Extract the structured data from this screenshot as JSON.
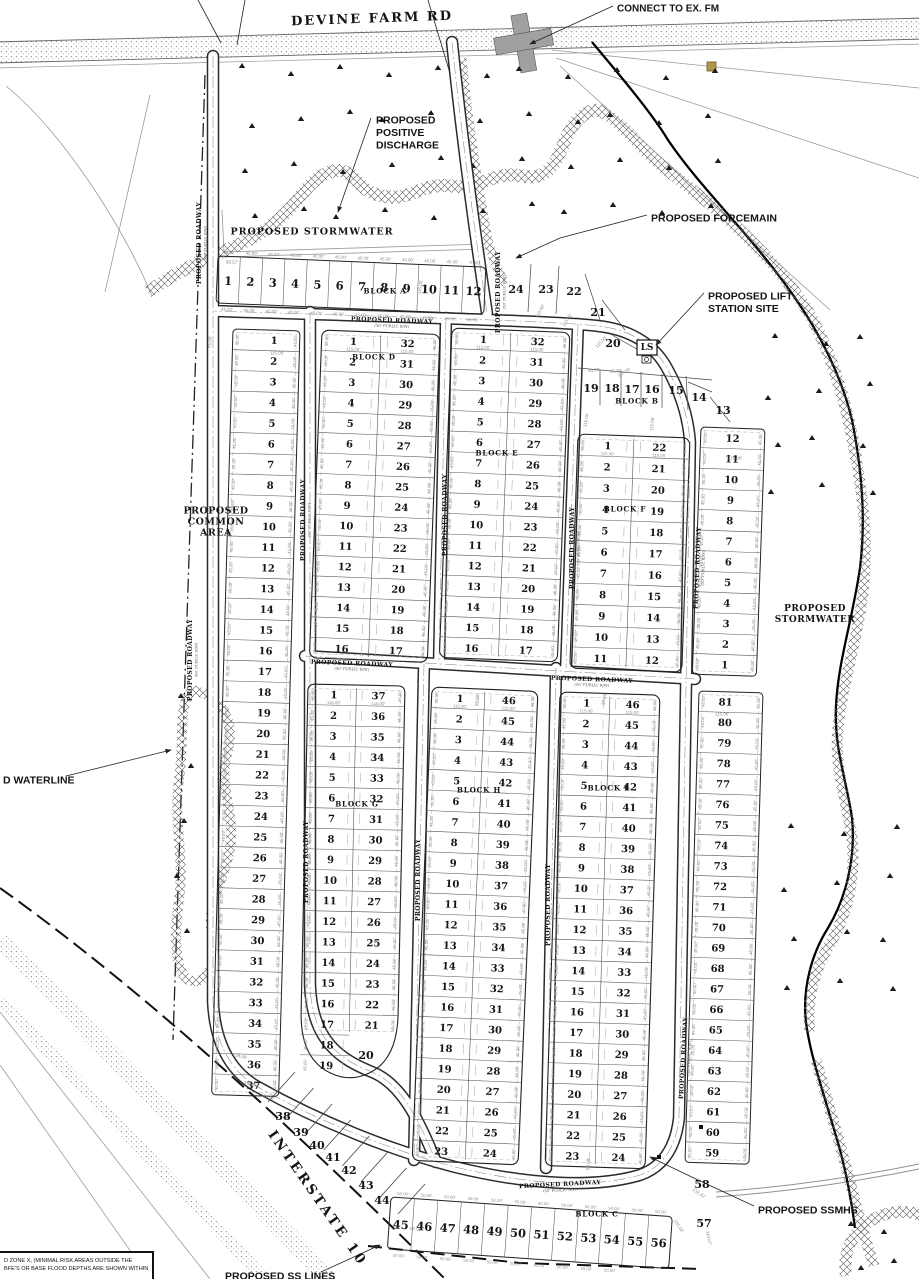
{
  "defaults": {
    "roadway_label": "PROPOSED ROADWAY",
    "lot_side_dim": "45.00'",
    "lot_depth_dim": "115.00'"
  },
  "note_box": {
    "line1": "D ZONE X, (MINIMAL RISK AREAS OUTSIDE THE",
    "line2": "BFE'S OR BASE FLOOD DEPTHS ARE SHOWN WITHIN"
  },
  "ls_box": {
    "label": "LS"
  },
  "annotations": [
    {
      "name": "connect-to-ex-fm",
      "lines": [
        "CONNECT TO EX. FM"
      ],
      "x": 617,
      "y": 8,
      "anchor": "start",
      "fs": 10,
      "leader": [
        [
          613,
          6
        ],
        [
          530,
          44
        ]
      ],
      "arrow": true
    },
    {
      "name": "proposed-positive-discharge",
      "lines": [
        "PROPOSED",
        "POSITIVE",
        "DISCHARGE"
      ],
      "x": 376,
      "y": 120,
      "anchor": "start",
      "fs": 10.5,
      "leader": [
        [
          371,
          118
        ],
        [
          338,
          212
        ]
      ],
      "arrow": true
    },
    {
      "name": "proposed-stormwater-top",
      "lines": [
        "PROPOSED STORMWATER"
      ],
      "x": 312,
      "y": 231,
      "anchor": "middle",
      "fs": 9.5,
      "serif": true,
      "ls": 1
    },
    {
      "name": "proposed-forcemain",
      "lines": [
        "PROPOSED FORCEMAIN"
      ],
      "x": 651,
      "y": 218,
      "anchor": "start",
      "fs": 10.5,
      "leader": [
        [
          647,
          215
        ],
        [
          560,
          238
        ],
        [
          516,
          258
        ]
      ],
      "arrow": true
    },
    {
      "name": "proposed-lift-station-site",
      "lines": [
        "PROPOSED LIFT",
        "STATION SITE"
      ],
      "x": 708,
      "y": 296,
      "anchor": "start",
      "fs": 10.5,
      "leader": [
        [
          704,
          293
        ],
        [
          656,
          345
        ]
      ],
      "arrow": true
    },
    {
      "name": "proposed-stormwater-right",
      "lines": [
        "PROPOSED",
        "STORMWATER"
      ],
      "x": 815,
      "y": 608,
      "anchor": "middle",
      "fs": 9,
      "serif": true,
      "ls": 0.5
    },
    {
      "name": "proposed-common-area",
      "lines": [
        "PROPOSED",
        "COMMON",
        "AREA"
      ],
      "x": 216,
      "y": 510,
      "anchor": "middle",
      "fs": 9.5,
      "serif": true,
      "ls": 0.5
    },
    {
      "name": "proposed-waterline",
      "lines": [
        "D WATERLINE"
      ],
      "x": 3,
      "y": 780,
      "anchor": "start",
      "fs": 10.5,
      "leader": [
        [
          66,
          776
        ],
        [
          171,
          750
        ]
      ],
      "arrow": true
    },
    {
      "name": "proposed-ssmhs",
      "lines": [
        "PROPOSED SSMHS"
      ],
      "x": 758,
      "y": 1210,
      "anchor": "start",
      "fs": 10.5,
      "leader": [
        [
          754,
          1206
        ],
        [
          698,
          1180
        ],
        [
          650,
          1157
        ]
      ],
      "arrow": true
    },
    {
      "name": "proposed-ss-lines",
      "lines": [
        "PROPOSED SS LINES"
      ],
      "x": 225,
      "y": 1276,
      "anchor": "start",
      "fs": 10.5,
      "leader": [
        [
          321,
          1272
        ],
        [
          380,
          1245
        ]
      ],
      "arrow": true
    },
    {
      "name": "devine-farm-rd",
      "lines": [
        "DEVINE FARM RD"
      ],
      "x": 372,
      "y": 18,
      "anchor": "middle",
      "fs": 13,
      "serif": true,
      "rot": -2,
      "ls": 2
    },
    {
      "name": "interstate-10",
      "lines": [
        "INTERSTATE 10"
      ],
      "x": 318,
      "y": 1198,
      "anchor": "middle",
      "fs": 13.5,
      "serif": true,
      "rot": 55,
      "ls": 3
    }
  ],
  "road_labels": [
    {
      "x": 392,
      "y": 320,
      "rot": 2,
      "sub": "(50' PUBLIC R/W)"
    },
    {
      "x": 199,
      "y": 243,
      "rot": -90,
      "sub": "(60' PUBLIC R/W)"
    },
    {
      "x": 190,
      "y": 660,
      "rot": -90,
      "sub": "(60' PUBLIC R/W)"
    },
    {
      "x": 303,
      "y": 520,
      "rot": -90,
      "sub": "(50' PUBLIC R/W)"
    },
    {
      "x": 306,
      "y": 862,
      "rot": -90,
      "sub": ""
    },
    {
      "x": 498,
      "y": 292,
      "rot": -90,
      "sub": "(50' PUBLIC R/W)"
    },
    {
      "x": 445,
      "y": 515,
      "rot": -90,
      "sub": ""
    },
    {
      "x": 572,
      "y": 548,
      "rot": -90,
      "sub": "(50' PUBLIC R/W)"
    },
    {
      "x": 352,
      "y": 663,
      "rot": 2,
      "sub": "(50' PUBLIC R/W)"
    },
    {
      "x": 592,
      "y": 679,
      "rot": 2,
      "sub": "(50' PUBLIC R/W)"
    },
    {
      "x": 418,
      "y": 880,
      "rot": -90,
      "sub": ""
    },
    {
      "x": 548,
      "y": 905,
      "rot": -90,
      "sub": ""
    },
    {
      "x": 697,
      "y": 568,
      "rot": -88,
      "sub": "(50' PUBLIC R/W)"
    },
    {
      "x": 683,
      "y": 1058,
      "rot": -87,
      "sub": "(50' PUBLIC R/W)"
    },
    {
      "x": 560,
      "y": 1184,
      "rot": -3,
      "sub": "(50' PUBLIC R/W)"
    }
  ],
  "block_labels": [
    {
      "t": "BLOCK A",
      "x": 385,
      "y": 291
    },
    {
      "t": "BLOCK B",
      "x": 637,
      "y": 401
    },
    {
      "t": "BLOCK C",
      "x": 597,
      "y": 1214
    },
    {
      "t": "BLOCK D",
      "x": 374,
      "y": 357
    },
    {
      "t": "BLOCK E",
      "x": 497,
      "y": 453
    },
    {
      "t": "BLOCK F",
      "x": 625,
      "y": 509
    },
    {
      "t": "BLOCK G",
      "x": 357,
      "y": 804
    },
    {
      "t": "BLOCK H",
      "x": 479,
      "y": 790
    },
    {
      "t": "BLOCK I",
      "x": 608,
      "y": 788
    }
  ],
  "blocks": [
    {
      "id": "D",
      "x": 322,
      "y": 330,
      "w": 118,
      "rh": 20.5,
      "rot": 2.2,
      "left": [
        1,
        2,
        3,
        4,
        5,
        6,
        7,
        8,
        9,
        10,
        11,
        12,
        13,
        14,
        15,
        16
      ],
      "right": [
        32,
        31,
        30,
        29,
        28,
        27,
        26,
        25,
        24,
        23,
        22,
        21,
        20,
        19,
        18,
        17
      ]
    },
    {
      "id": "E",
      "x": 452,
      "y": 328,
      "w": 118,
      "rh": 20.6,
      "rot": 2.2,
      "left": [
        1,
        2,
        3,
        4,
        5,
        6,
        7,
        8,
        9,
        10,
        11,
        12,
        13,
        14,
        15,
        16
      ],
      "right": [
        32,
        31,
        30,
        29,
        28,
        27,
        26,
        25,
        24,
        23,
        22,
        21,
        20,
        19,
        18,
        17
      ]
    },
    {
      "id": "F",
      "x": 578,
      "y": 434,
      "w": 112,
      "rh": 21.3,
      "rot": 2.0,
      "left": [
        1,
        2,
        3,
        4,
        5,
        6,
        7,
        8,
        9,
        10,
        11
      ],
      "right": [
        22,
        21,
        20,
        19,
        18,
        17,
        16,
        15,
        14,
        13,
        12
      ]
    },
    {
      "id": "G",
      "x": 308,
      "y": 684,
      "w": 97,
      "rh": 20.6,
      "rot": 1.2,
      "bulb": true,
      "left": [
        1,
        2,
        3,
        4,
        5,
        6,
        7,
        8,
        9,
        10,
        11,
        12,
        13,
        14,
        15,
        16,
        17,
        18,
        19
      ],
      "right": [
        37,
        36,
        35,
        34,
        33,
        32,
        31,
        30,
        29,
        28,
        27,
        26,
        25,
        24,
        23,
        22,
        21
      ]
    },
    {
      "id": "H",
      "x": 432,
      "y": 687,
      "w": 106,
      "rh": 20.6,
      "rot": 2.4,
      "left": [
        1,
        2,
        3,
        4,
        5,
        6,
        7,
        8,
        9,
        10,
        11,
        12,
        13,
        14,
        15,
        16,
        17,
        18,
        19,
        20,
        21,
        22,
        23
      ],
      "right": [
        46,
        45,
        44,
        43,
        42,
        41,
        40,
        39,
        38,
        37,
        36,
        35,
        34,
        33,
        32,
        31,
        30,
        29,
        28,
        27,
        26,
        25,
        24
      ]
    },
    {
      "id": "I",
      "x": 560,
      "y": 692,
      "w": 100,
      "rh": 20.6,
      "rot": 1.8,
      "left": [
        1,
        2,
        3,
        4,
        5,
        6,
        7,
        8,
        9,
        10,
        11,
        12,
        13,
        14,
        15,
        16,
        17,
        18,
        19,
        20,
        21,
        22,
        23
      ],
      "right": [
        46,
        45,
        44,
        43,
        42,
        41,
        40,
        39,
        38,
        37,
        36,
        35,
        34,
        33,
        32,
        31,
        30,
        29,
        28,
        27,
        26,
        25,
        24
      ]
    }
  ],
  "col_strips": [
    {
      "id": "west",
      "x": 233,
      "y": 329,
      "w": 67,
      "rh": 20.7,
      "rot": 1.6,
      "numpos": 0.62,
      "numbers": [
        1,
        2,
        3,
        4,
        5,
        6,
        7,
        8,
        9,
        10,
        11,
        12,
        13,
        14,
        15,
        16,
        17,
        18,
        19,
        20,
        21,
        22,
        23,
        24,
        25,
        26,
        27,
        28,
        29,
        30,
        31,
        32,
        33,
        34,
        35,
        36,
        37
      ]
    },
    {
      "id": "east-upper",
      "x": 701,
      "y": 427,
      "w": 64,
      "rh": 20.6,
      "rot": 2.0,
      "numpos": 0.5,
      "numbers": [
        12,
        11,
        10,
        9,
        8,
        7,
        6,
        5,
        4,
        3,
        2,
        1
      ]
    },
    {
      "id": "east-lower",
      "x": 699,
      "y": 691,
      "w": 64,
      "rh": 20.5,
      "rot": 1.7,
      "numpos": 0.42,
      "numbers": [
        81,
        80,
        79,
        78,
        77,
        76,
        75,
        74,
        73,
        72,
        71,
        70,
        69,
        68,
        67,
        66,
        65,
        64,
        63,
        62,
        61,
        60,
        59
      ]
    }
  ],
  "row_strips": [
    {
      "id": "A",
      "x": 218,
      "y": 256,
      "w": 268,
      "h": 47,
      "rot": 2.4,
      "numbers": [
        1,
        2,
        3,
        4,
        5,
        6,
        7,
        8,
        9,
        10,
        11,
        12
      ],
      "top_dims": [
        "68.57'",
        "45.00'",
        "45.00'",
        "45.00'",
        "45.00'",
        "45.00'",
        "45.00'",
        "45.00'",
        "45.00'",
        "45.00'",
        "45.00'",
        "70.00'"
      ],
      "bottom_dims": [
        "45.00'",
        "45.00'",
        "45.00'",
        "45.00'",
        "45.00'",
        "45.00'",
        "45.00'",
        "45.00'",
        "45.00'",
        "45.00'",
        "45.00'",
        "45.00'"
      ]
    },
    {
      "id": "C",
      "x": 391,
      "y": 1197,
      "w": 282,
      "h": 52,
      "rot": 4,
      "numbers": [
        45,
        46,
        47,
        48,
        49,
        50,
        51,
        52,
        53,
        54,
        55,
        56
      ],
      "top_dims": [
        "50.00'",
        "50.00'",
        "50.00'",
        "50.00'",
        "50.00'",
        "50.00'",
        "50.00'",
        "50.00'",
        "50.00'",
        "50.00'",
        "50.00'",
        "50.00'"
      ],
      "bottom_dims": [
        "50.00'",
        "50.00'",
        "50.00'",
        "50.00'",
        "50.00'",
        "50.00'",
        "50.00'",
        "50.00'",
        "50.00'",
        "50.00'"
      ]
    }
  ],
  "loose_lots": [
    {
      "n": 24,
      "x": 516,
      "y": 289
    },
    {
      "n": 23,
      "x": 546,
      "y": 289
    },
    {
      "n": 22,
      "x": 574,
      "y": 291
    },
    {
      "n": 21,
      "x": 598,
      "y": 312
    },
    {
      "n": 20,
      "x": 613,
      "y": 343
    },
    {
      "n": 19,
      "x": 591,
      "y": 388
    },
    {
      "n": 18,
      "x": 612,
      "y": 388
    },
    {
      "n": 17,
      "x": 632,
      "y": 389
    },
    {
      "n": 16,
      "x": 652,
      "y": 389
    },
    {
      "n": 15,
      "x": 676,
      "y": 390
    },
    {
      "n": 14,
      "x": 699,
      "y": 397
    },
    {
      "n": 13,
      "x": 723,
      "y": 410
    },
    {
      "n": 20,
      "x": 366,
      "y": 1055
    },
    {
      "n": 38,
      "x": 283,
      "y": 1116
    },
    {
      "n": 39,
      "x": 301,
      "y": 1132
    },
    {
      "n": 40,
      "x": 317,
      "y": 1145
    },
    {
      "n": 41,
      "x": 333,
      "y": 1157
    },
    {
      "n": 42,
      "x": 349,
      "y": 1170
    },
    {
      "n": 43,
      "x": 366,
      "y": 1185
    },
    {
      "n": 44,
      "x": 382,
      "y": 1200
    },
    {
      "n": 57,
      "x": 704,
      "y": 1223
    },
    {
      "n": 58,
      "x": 702,
      "y": 1184
    }
  ],
  "special_dims": [
    {
      "t": "68.57'",
      "x": 232,
      "y": 262,
      "rot": 2
    },
    {
      "t": "115.00'",
      "x": 277,
      "y": 353,
      "rot": 0
    },
    {
      "t": "75.00'",
      "x": 210,
      "y": 342,
      "rot": -90
    },
    {
      "t": "115.00'",
      "x": 420,
      "y": 287,
      "rot": -80
    },
    {
      "t": "115.00'",
      "x": 540,
      "y": 311,
      "rot": -62
    },
    {
      "t": "115.00'",
      "x": 567,
      "y": 320,
      "rot": -55
    },
    {
      "t": "115.00'",
      "x": 601,
      "y": 342,
      "rot": -45
    },
    {
      "t": "115.00'",
      "x": 624,
      "y": 372,
      "rot": -30
    },
    {
      "t": "45.00'",
      "x": 594,
      "y": 370,
      "rot": -8
    },
    {
      "t": "45.00'",
      "x": 616,
      "y": 371,
      "rot": -5
    },
    {
      "t": "115.00'",
      "x": 586,
      "y": 420,
      "rot": -80
    },
    {
      "t": "115.00'",
      "x": 652,
      "y": 424,
      "rot": -85
    },
    {
      "t": "115.00'",
      "x": 735,
      "y": 458,
      "rot": 0
    },
    {
      "t": "115.00'",
      "x": 722,
      "y": 714,
      "rot": 0
    },
    {
      "t": "128.69'",
      "x": 240,
      "y": 1056,
      "rot": 12
    },
    {
      "t": "138.85'",
      "x": 251,
      "y": 1084,
      "rot": 16
    },
    {
      "t": "116.97'",
      "x": 268,
      "y": 1097,
      "rot": 20
    },
    {
      "t": "65.50'",
      "x": 416,
      "y": 1229,
      "rot": 8
    },
    {
      "t": "132.32'",
      "x": 699,
      "y": 1193,
      "rot": 35
    },
    {
      "t": "161.02'",
      "x": 679,
      "y": 1226,
      "rot": 55
    },
    {
      "t": "110.07'",
      "x": 709,
      "y": 1238,
      "rot": 80
    },
    {
      "t": "60.08'",
      "x": 588,
      "y": 1164,
      "rot": -87
    },
    {
      "t": "55.00'",
      "x": 477,
      "y": 700,
      "rot": -85
    },
    {
      "t": "33.06'",
      "x": 604,
      "y": 699,
      "rot": -80
    }
  ]
}
